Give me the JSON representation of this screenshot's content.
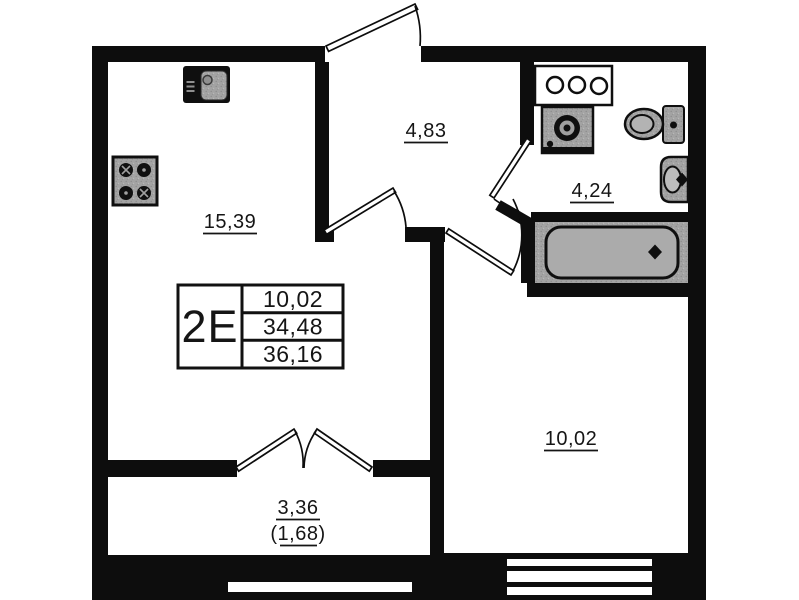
{
  "unit": {
    "type_label": "2E"
  },
  "table": {
    "rows": [
      "10,02",
      "34,48",
      "36,16"
    ]
  },
  "rooms": {
    "kitchen_living": "15,39",
    "hall": "4,83",
    "bathroom": "4,24",
    "bedroom": "10,02",
    "balcony_total": "3,36",
    "balcony_reduced": "(1,68)"
  },
  "fixtures": {
    "kitchen_sink": "kitchen-sink",
    "stove": "stove-4-burners",
    "bath_counter": "counter-three-holes",
    "washing_machine": "washing-machine",
    "toilet": "toilet",
    "washbasin": "washbasin",
    "bathtub": "bathtub"
  },
  "colors": {
    "wall": "#0d0d0d",
    "fixture_gray": "#a3a3a3",
    "background": "#ffffff"
  }
}
